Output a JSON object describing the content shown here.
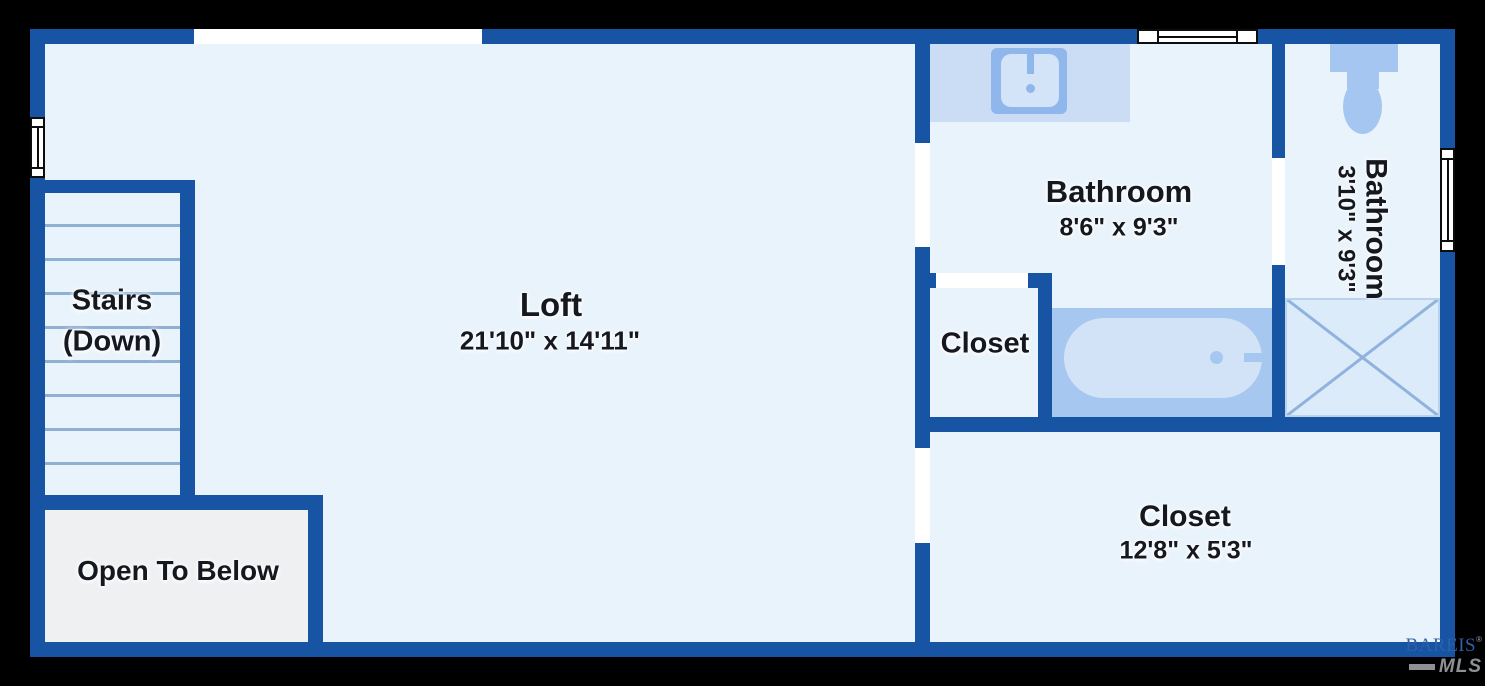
{
  "plan_title": "Loft level floor plan",
  "rooms": {
    "loft": {
      "name": "Loft",
      "dims": "21'10\" x 14'11\""
    },
    "stairs": {
      "name": "Stairs",
      "sub": "(Down)"
    },
    "open_to_below": {
      "name": "Open To Below"
    },
    "bathroom_main": {
      "name": "Bathroom",
      "dims": "8'6\" x 9'3\""
    },
    "bathroom_ensuite": {
      "name": "Bathroom",
      "dims": "3'10\" x 9'3\""
    },
    "closet_small": {
      "name": "Closet"
    },
    "closet_large": {
      "name": "Closet",
      "dims": "12'8\" x 5'3\""
    }
  },
  "fixtures": [
    "sink",
    "toilet",
    "bathtub",
    "shower",
    "stairs-steps",
    "windows",
    "door-openings"
  ],
  "watermark": {
    "brand": "BAREIS",
    "registered": "®",
    "sub": "MLS"
  },
  "colors": {
    "background": "#000000",
    "wall": "#1754a4",
    "floor": "#e9f3fb",
    "open_to_below_floor": "#eef0f2",
    "counter": "#caddf4",
    "fixture_medium": "#8fb7ec",
    "fixture_soft": "#a6c7ef",
    "fixture_light": "#d3e4f8",
    "shower_floor": "#dcebfa",
    "shower_cross": "#8fb3dd",
    "stair_line": "#8fb0d3",
    "label_text": "#15181f",
    "brand_blue": "#2e5fa9",
    "brand_gray": "#8e9194"
  }
}
